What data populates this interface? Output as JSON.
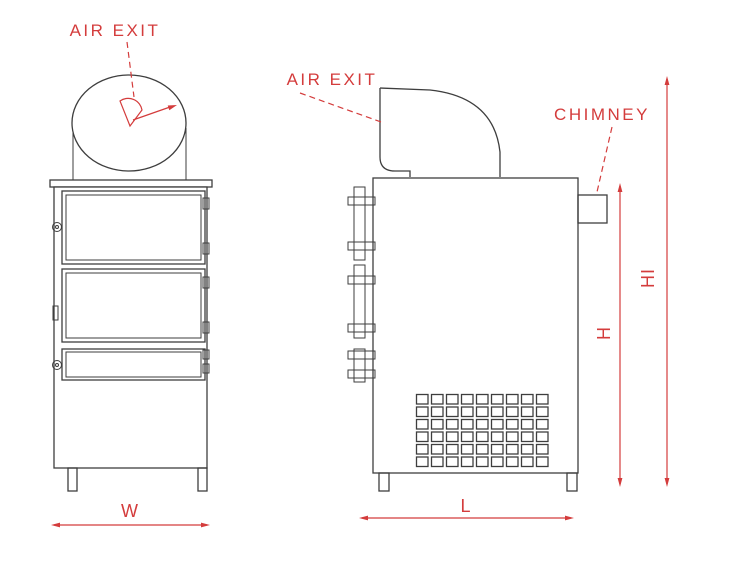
{
  "drawing": {
    "colors": {
      "annotation_red": "#d43c3c",
      "line_dark": "#3e3e3e"
    },
    "front_view": {
      "air_exit_label": "AIR EXIT",
      "width_dim_label": "W"
    },
    "side_view": {
      "air_exit_label": "AIR EXIT",
      "chimney_label": "CHIMNEY",
      "length_dim_label": "L",
      "body_height_dim_label": "H",
      "total_height_dim_label": "HI"
    }
  }
}
